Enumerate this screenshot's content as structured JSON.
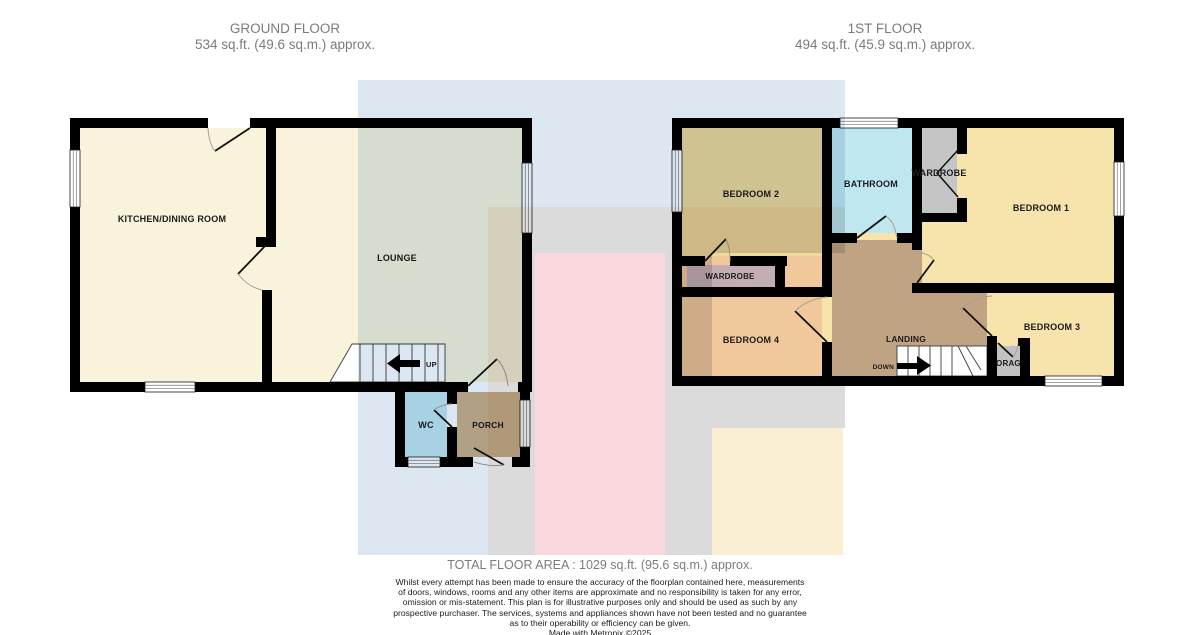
{
  "ground_floor": {
    "title": "GROUND FLOOR",
    "area": "534 sq.ft. (49.6 sq.m.) approx.",
    "labels": {
      "kitchen": "KITCHEN/DINING ROOM",
      "lounge": "LOUNGE",
      "up": "UP",
      "wc": "WC",
      "porch": "PORCH"
    }
  },
  "first_floor": {
    "title": "1ST FLOOR",
    "area": "494 sq.ft. (45.9 sq.m.) approx.",
    "labels": {
      "bedroom1": "BEDROOM 1",
      "bedroom2": "BEDROOM 2",
      "bedroom3": "BEDROOM 3",
      "bedroom4": "BEDROOM 4",
      "bathroom": "BATHROOM",
      "wardrobe_top": "WARDROBE",
      "wardrobe_left": "WARDROBE",
      "landing": "LANDING",
      "storage": "STORAGE",
      "down": "DOWN"
    }
  },
  "footer": {
    "total_area": "TOTAL FLOOR AREA : 1029 sq.ft. (95.6 sq.m.) approx.",
    "disclaimer_lines": [
      "Whilst every attempt has been made to ensure the accuracy of the floorplan contained here, measurements",
      "of doors, windows, rooms and any other items are approximate and no responsibility is taken for any error,",
      "omission or mis-statement. This plan is for illustrative purposes only and should be used as such by any",
      "prospective purchaser. The services, systems and appliances shown have not been tested and no guarantee",
      "as to their operability or efficiency can be given."
    ],
    "credit": "Made with Metropix ©2025"
  },
  "colors": {
    "wall": "#000000",
    "ground_inner": "#f8f3da",
    "first_inner": "#f6e4ac",
    "bedroom2": "#f0d79a",
    "bedroom4": "#f0c89c",
    "bathroom": "#bfe7f0",
    "wardrobe_grey": "#c5c5c5",
    "wardrobe_mauve": "#c4aeb4",
    "landing": "#bfa383",
    "storage": "#c2c2c2",
    "wc": "#c3e7f2",
    "porch": "#cdb18c",
    "wash_blue": "#dce7f1",
    "wash_grey": "#dbdbdc",
    "wash_pink": "#f9d9dd",
    "wash_cream": "#faeed3",
    "title_text": "#7b7b7b",
    "label_text": "#1b1b1b"
  }
}
